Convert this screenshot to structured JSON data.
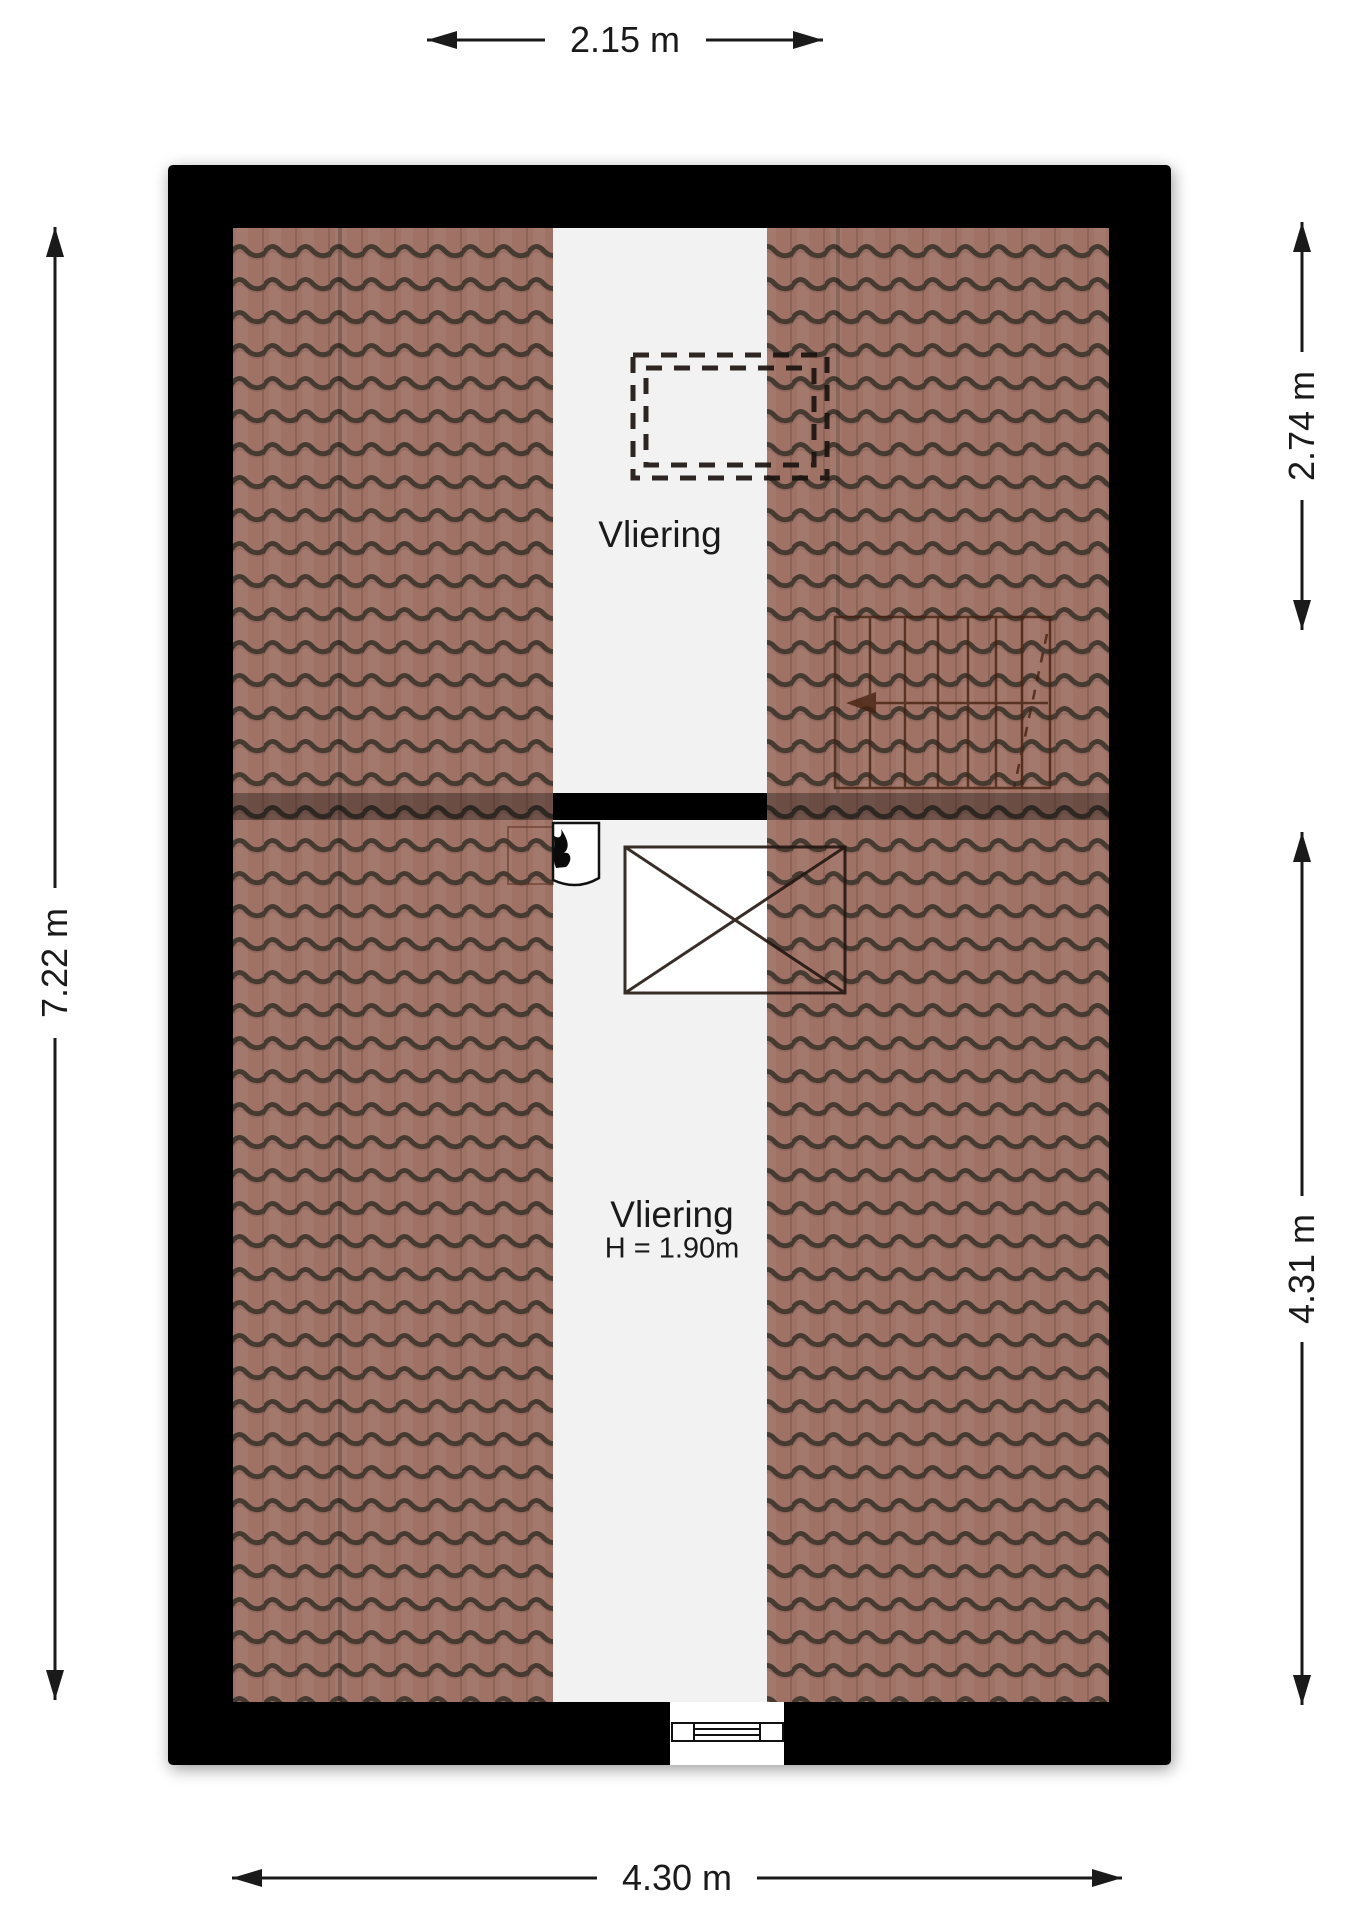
{
  "plan": {
    "dimensions": {
      "top": "2.15 m",
      "left": "7.22 m",
      "right_upper": "2.74 m",
      "right_lower": "4.31 m",
      "bottom": "4.30 m"
    },
    "rooms": {
      "upper": {
        "label": "Vliering"
      },
      "lower": {
        "label": "Vliering",
        "height_note": "H = 1.90m"
      }
    },
    "colors": {
      "wall": "#000000",
      "floor": "#f2f2f2",
      "roof_tile": "#9f7265",
      "roof_tile_line": "#463a31",
      "dimension_line": "#1a1a1a"
    }
  }
}
